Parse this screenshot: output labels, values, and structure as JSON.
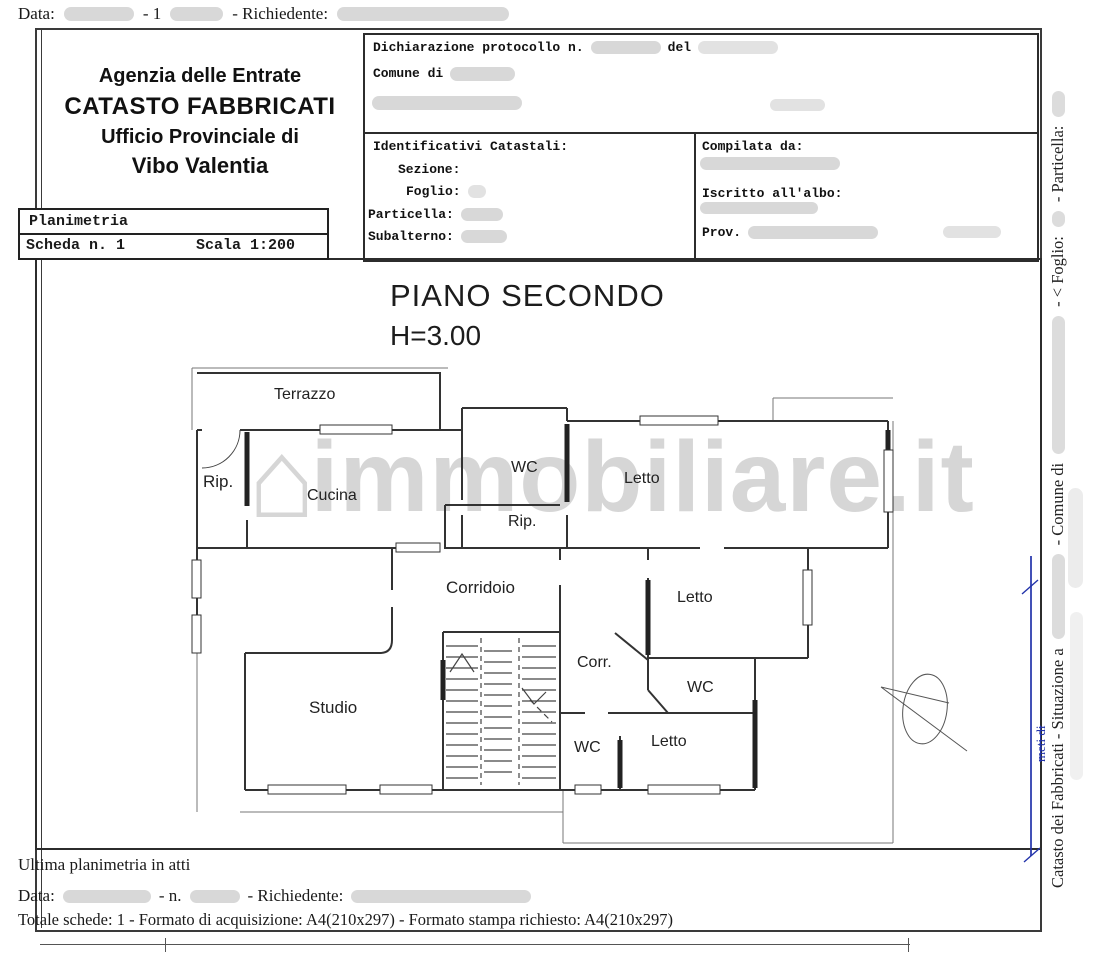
{
  "document": {
    "top_line": {
      "data_label": "Data:",
      "middle": "- 1",
      "richiedente_label": "- Richiedente:"
    },
    "agency_header": {
      "line1": "Agenzia delle Entrate",
      "line2": "CATASTO FABBRICATI",
      "line3": "Ufficio Provinciale di",
      "line4": "Vibo Valentia"
    },
    "protocol_box": {
      "dichiarazione_label": "Dichiarazione protocollo n.",
      "del_label": "del",
      "comune_label": "Comune di"
    },
    "identificativi": {
      "title": "Identificativi Catastali:",
      "sezione_label": "Sezione:",
      "foglio_label": "Foglio:",
      "particella_label": "Particella:",
      "subalterno_label": "Subalterno:"
    },
    "compilata": {
      "title": "Compilata da:",
      "albo_label": "Iscritto all'albo:",
      "prov_label": "Prov."
    },
    "planimetria_box": {
      "title": "Planimetria",
      "scheda": "Scheda n. 1",
      "scala": "Scala 1:200"
    },
    "plan": {
      "title": "PIANO SECONDO",
      "height": "H=3.00",
      "rooms": [
        {
          "label": "Terrazzo"
        },
        {
          "label": "Rip."
        },
        {
          "label": "Cucina"
        },
        {
          "label": "WC"
        },
        {
          "label": "Letto"
        },
        {
          "label": "Rip."
        },
        {
          "label": "Corridoio"
        },
        {
          "label": "Letto"
        },
        {
          "label": "Studio"
        },
        {
          "label": "Corr."
        },
        {
          "label": "WC"
        },
        {
          "label": "WC"
        },
        {
          "label": "Letto"
        }
      ]
    },
    "watermark": {
      "icon": "⌂",
      "text": "immobiliare.it"
    },
    "side_column": {
      "catasto": "Catasto dei Fabbricati - Situazione a",
      "comune": "- Comune di",
      "foglio": "- < Foglio:",
      "particella": "- Particella:",
      "blue_note": "meti di"
    },
    "footer": {
      "ultima": "Ultima planimetria in atti",
      "data_label": "Data:",
      "n_label": "- n.",
      "richiedente_label": "- Richiedente:",
      "totale": "Totale schede: 1 - Formato di acquisizione: A4(210x297)  - Formato stampa richiesto: A4(210x297)"
    },
    "colors": {
      "redaction": "#d8d8d8",
      "blue_annotation": "#2233aa",
      "wall": "#333333",
      "watermark_gray": "#ababab"
    }
  }
}
